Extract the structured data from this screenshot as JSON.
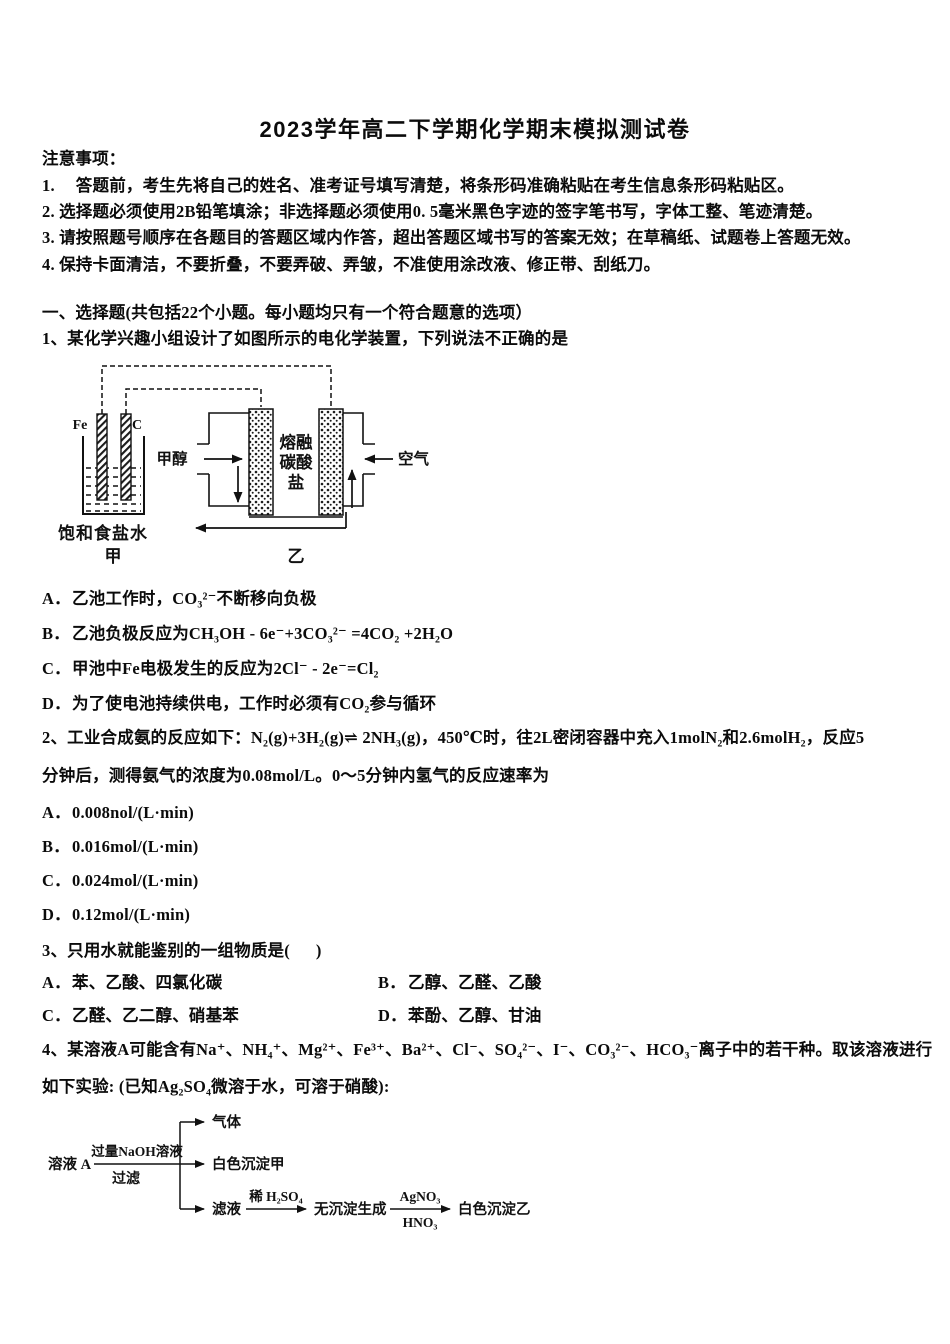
{
  "title": "2023学年高二下学期化学期末模拟测试卷",
  "notice": {
    "heading": "注意事项：",
    "items": [
      "1.　 答题前，考生先将自己的姓名、准考证号填写清楚，将条形码准确粘贴在考生信息条形码粘贴区。",
      "2. 选择题必须使用2B铅笔填涂；非选择题必须使用0. 5毫米黑色字迹的签字笔书写，字体工整、笔迹清楚。",
      "3. 请按照题号顺序在各题目的答题区域内作答，超出答题区域书写的答案无效；在草稿纸、试题卷上答题无效。",
      "4. 保持卡面清洁，不要折叠，不要弄破、弄皱，不准使用涂改液、修正带、刮纸刀。"
    ]
  },
  "section_heading": "一、选择题(共包括22个小题。每小题均只有一个符合题意的选项）",
  "q1": {
    "stem": "1、某化学兴趣小组设计了如图所示的电化学装置，下列说法不正确的是",
    "diagram": {
      "electrode_fe": "Fe",
      "electrode_c": "C",
      "fuel_label": "甲醇",
      "air_label": "空气",
      "electrolyte": [
        "熔融",
        "碳酸",
        "盐"
      ],
      "brine_label": "饱和食盐水",
      "cell_left_name": "甲",
      "cell_right_name": "乙"
    },
    "options": [
      {
        "label": "A．",
        "text": "乙池工作时，CO₃²⁻不断移向负极"
      },
      {
        "label": "B．",
        "text": "乙池负极反应为CH₃OH - 6e⁻+3CO₃²⁻ =4CO₂ +2H₂O"
      },
      {
        "label": "C．",
        "text": "甲池中Fe电极发生的反应为2Cl⁻ - 2e⁻=Cl₂"
      },
      {
        "label": "D．",
        "text": "为了使电池持续供电，工作时必须有CO₂参与循环"
      }
    ]
  },
  "q2": {
    "stem_lines": [
      "2、工业合成氨的反应如下：N₂(g)+3H₂(g)⇌ 2NH₃(g)，450℃时，往2L密闭容器中充入1molN₂和2.6molH₂，反应5",
      "分钟后，测得氨气的浓度为0.08mol/L。0～5分钟内氢气的反应速率为"
    ],
    "options": [
      {
        "label": "A．",
        "text": "0.008nol/(L·min)"
      },
      {
        "label": "B．",
        "text": "0.016mol/(L·min)"
      },
      {
        "label": "C．",
        "text": "0.024mol/(L·min)"
      },
      {
        "label": "D．",
        "text": "0.12mol/(L·min)"
      }
    ]
  },
  "q3": {
    "stem": "3、只用水就能鉴别的一组物质是(      )",
    "options": [
      {
        "label": "A．",
        "text": "苯、乙酸、四氯化碳"
      },
      {
        "label": "B．",
        "text": "乙醇、乙醛、乙酸"
      },
      {
        "label": "C．",
        "text": "乙醛、乙二醇、硝基苯"
      },
      {
        "label": "D．",
        "text": "苯酚、乙醇、甘油"
      }
    ]
  },
  "q4": {
    "stem_lines": [
      "4、某溶液A可能含有Na⁺、NH₄⁺、Mg²⁺、Fe³⁺、Ba²⁺、Cl⁻、SO₄²⁻、I⁻、CO₃²⁻、HCO₃⁻离子中的若干种。取该溶液进行",
      "如下实验: (已知Ag₂SO₄微溶于水，可溶于硝酸):"
    ],
    "flowchart": {
      "solution": "溶液 A",
      "step1_above": "过量NaOH溶液",
      "step1_below": "过滤",
      "branch_gas": "气体",
      "branch_precipitate_a": "白色沉淀甲",
      "branch_filtrate": "滤液",
      "step2_above": "稀 H₂SO₄",
      "result_no_precipitate": "无沉淀生成",
      "step3_above": "AgNO₃",
      "step3_below": "HNO₃",
      "result_precipitate_b": "白色沉淀乙"
    }
  }
}
